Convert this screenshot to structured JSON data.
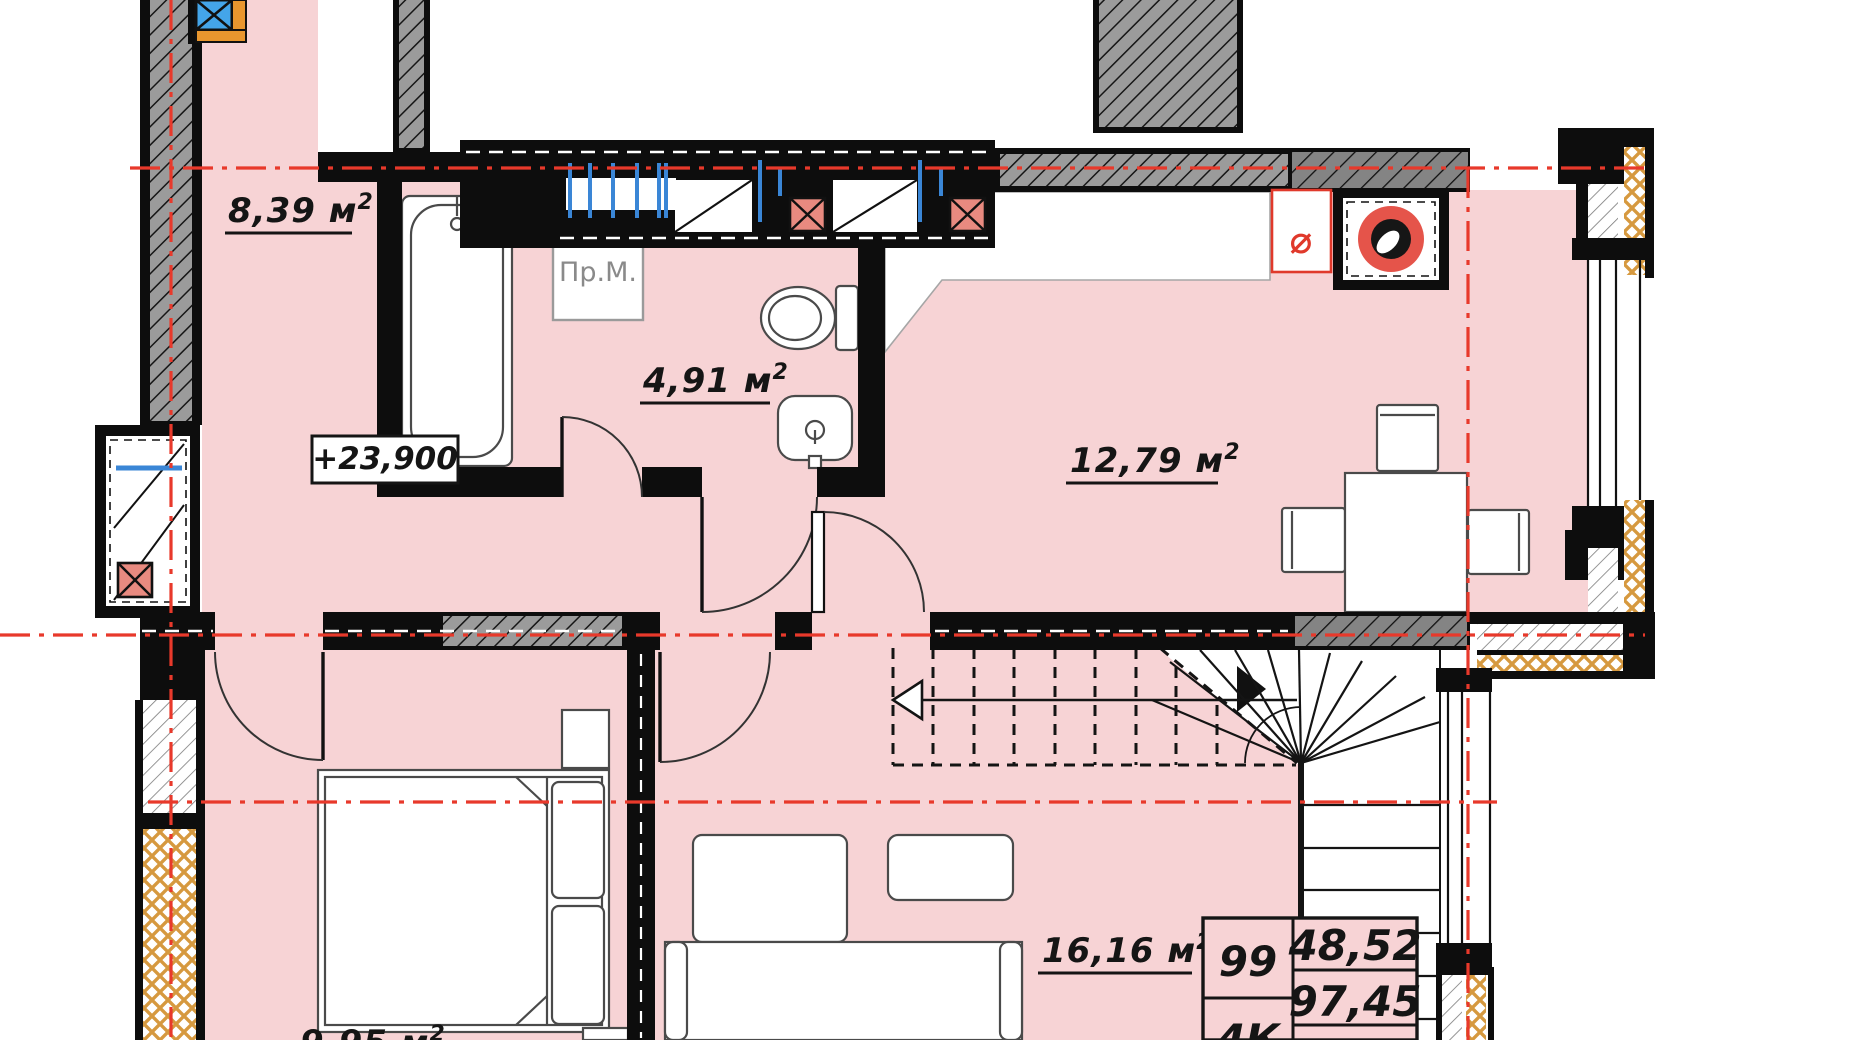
{
  "plan": {
    "type": "apartment-floor-plan",
    "colors": {
      "floor_pink": "#f7d3d5",
      "wall_black": "#0d0d0d",
      "axis_red": "#e8392b",
      "vent_red_box": "#e88a80",
      "vent_blue": "#3a86d6",
      "corner_blue_box": "#44a5e9",
      "corner_orange": "#e8962e",
      "insulation_orange": "#d6993f",
      "hatch_gray": "#9b9b9b"
    },
    "rooms": [
      {
        "id": "hall",
        "area": "8,39 м",
        "sup": "2"
      },
      {
        "id": "bathroom",
        "area": "4,91 м",
        "sup": "2"
      },
      {
        "id": "kitchen-dining",
        "area": "12,79 м",
        "sup": "2"
      },
      {
        "id": "living",
        "area": "16,16 м",
        "sup": "2"
      },
      {
        "id": "bedroom",
        "area": "9,95 м",
        "sup": "2"
      }
    ],
    "elevation_mark": "+23,900",
    "appliance_label": "Пр.М.",
    "duct_symbol": "⌀",
    "stamp": {
      "apartment_number": "99",
      "living_area": "48,52",
      "total_area": "97,45",
      "rooms_count": "4К"
    }
  }
}
